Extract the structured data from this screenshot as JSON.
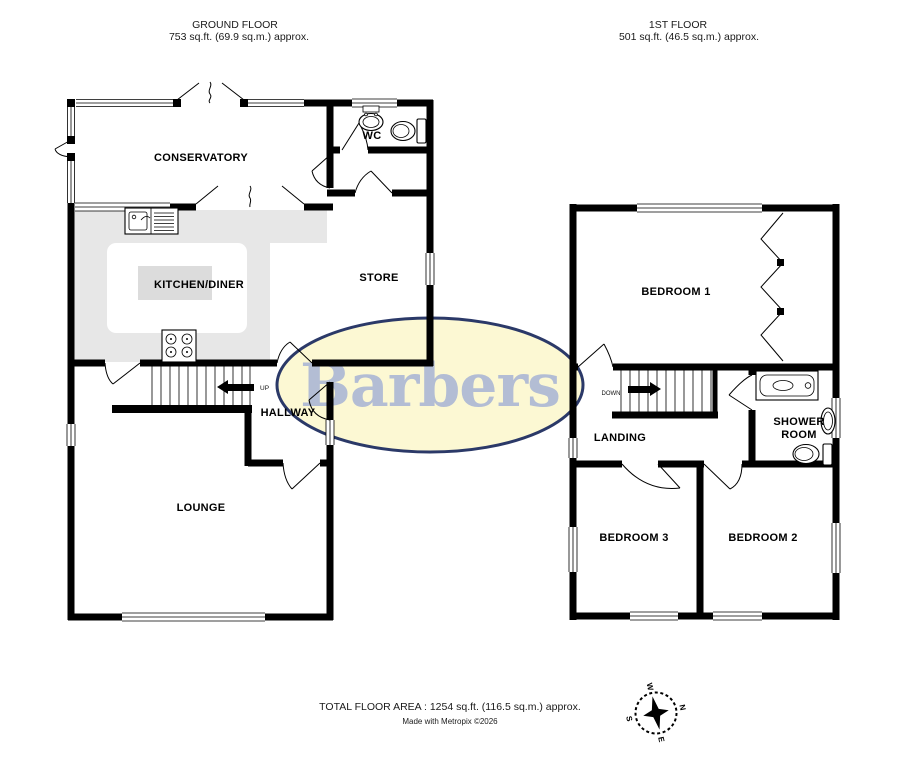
{
  "headers": {
    "ground": {
      "title": "GROUND FLOOR",
      "area": "753 sq.ft. (69.9 sq.m.) approx."
    },
    "first": {
      "title": "1ST FLOOR",
      "area": "501 sq.ft. (46.5 sq.m.) approx."
    }
  },
  "footer": {
    "total_area": "TOTAL FLOOR AREA : 1254 sq.ft. (116.5 sq.m.) approx.",
    "credit": "Made with Metropix ©2026"
  },
  "watermark": {
    "text": "Barbers",
    "fill_color": "#FCF8D3",
    "border_color": "#2B3968",
    "text_color": "#B3BDD4"
  },
  "ground_floor": {
    "conservatory": "CONSERVATORY",
    "wc": "WC",
    "kitchen_diner": "KITCHEN/DINER",
    "store": "STORE",
    "hallway": "HALLWAY",
    "lounge": "LOUNGE",
    "stairs_direction": "UP"
  },
  "first_floor": {
    "bedroom1": "BEDROOM 1",
    "landing": "LANDING",
    "shower_room_line1": "SHOWER",
    "shower_room_line2": "ROOM",
    "bedroom3": "BEDROOM 3",
    "bedroom2": "BEDROOM 2",
    "stairs_direction": "DOWN"
  },
  "compass": {
    "north": "N",
    "east": "E",
    "south": "S",
    "west": "W"
  },
  "colors": {
    "kitchen_counter": "#E7E7E7",
    "kitchen_island": "#DCDCDC"
  }
}
